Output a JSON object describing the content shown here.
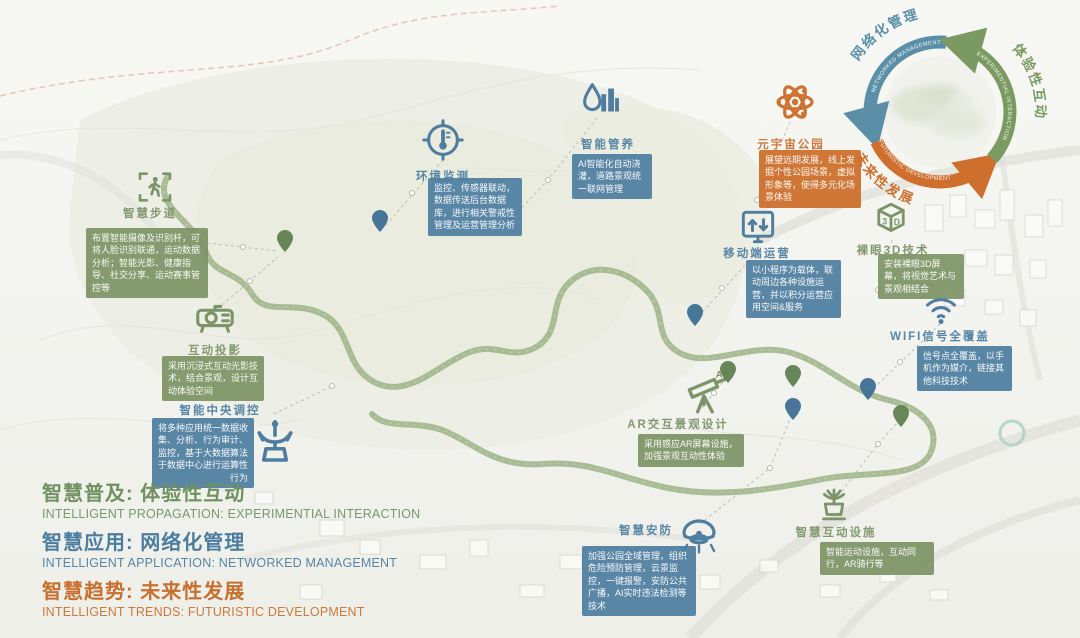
{
  "legend": {
    "items": [
      {
        "zh": "智慧普及: 体验性互动",
        "en": "INTELLIGENT PROPAGATION: EXPERIMENTIAL INTERACTION",
        "theme": "green"
      },
      {
        "zh": "智慧应用: 网络化管理",
        "en": "INTELLIGENT APPLICATION: NETWORKED MANAGEMENT",
        "theme": "blue"
      },
      {
        "zh": "智慧趋势: 未来性发展",
        "en": "INTELLIGENT TRENDS: FUTURISTIC DEVELOPMENT",
        "theme": "orange"
      }
    ]
  },
  "cycle": {
    "segments": [
      {
        "zh": "网络化管理",
        "en": "NETWORKED MANAGEMENT",
        "color": "#5b8fa8"
      },
      {
        "zh": "体验性互动",
        "en": "EXPERIMENTIAL INTERACTION",
        "color": "#7a9a62"
      },
      {
        "zh": "未来性发展",
        "en": "FUTURISTIC DEVELOPMENT",
        "color": "#cf6f2e"
      }
    ]
  },
  "callouts": [
    {
      "id": "walkway",
      "icon": "walking-trail-icon",
      "theme": "green",
      "label": "智慧步道",
      "desc": "布置智能摄像及识别杆，可将人脸识别联通，运动数据分析；智能光影、健康指导、社交分享、运动赛事管控等"
    },
    {
      "id": "projection",
      "icon": "projector-icon",
      "theme": "green",
      "label": "互动投影",
      "desc": "采用沉浸式互动光影技术，结合景观，设计互动体验空间"
    },
    {
      "id": "central",
      "icon": "control-tower-icon",
      "theme": "blue",
      "label": "智能中央调控",
      "desc": "将多种应用统一数据收集、分析、行为审计、监控，基于大数据算法于数据中心进行运算性行为"
    },
    {
      "id": "env",
      "icon": "thermometer-target-icon",
      "theme": "blue",
      "label": "环境监测",
      "desc": "监控、传感器联动，数据传送后台数据库，进行相关警戒性管理及运营管理分析"
    },
    {
      "id": "maintain",
      "icon": "water-greening-icon",
      "theme": "blue",
      "label": "智能管养",
      "desc": "AI智能化自动浇灌，道路景观统一联网管理"
    },
    {
      "id": "metaverse",
      "icon": "atom-icon",
      "theme": "orange",
      "label": "元宇宙公园",
      "desc": "展望远期发展，线上发掘个性公园场景，虚拟形象等，使得多元化场景体验"
    },
    {
      "id": "mobile",
      "icon": "mobile-monitor-icon",
      "theme": "blue",
      "label": "移动端运营",
      "desc": "以小程序为载体，联动周边各种设施运营，并以积分运营应用空间&服务"
    },
    {
      "id": "naked3d",
      "icon": "cube-3d-icon",
      "theme": "green",
      "label": "裸眼3D技术",
      "desc": "安装裸眼3D屏幕，将视觉艺术与景观相结合"
    },
    {
      "id": "wifi",
      "icon": "wifi-icon",
      "theme": "blue",
      "label": "WIFI信号全覆盖",
      "desc": "信号点全覆盖，以手机作为媒介，链接其他科技技术"
    },
    {
      "id": "ar",
      "icon": "ar-telescope-icon",
      "theme": "green",
      "label": "AR交互景观设计",
      "desc": "采用感应AR屏幕设施，加强景观互动性体验"
    },
    {
      "id": "security",
      "icon": "security-camera-icon",
      "theme": "blue",
      "label": "智慧安防",
      "desc": "加强公园全域管理，组织危险预防管理，云景监控，一键报警，安防公共广播，AI实时违法检测等技术"
    },
    {
      "id": "interactive",
      "icon": "fountain-facility-icon",
      "theme": "green",
      "label": "智慧互动设施",
      "desc": "智能运动设施，互动同行，AR骑行等"
    }
  ],
  "pins": [
    {
      "x": 285,
      "y": 252,
      "theme": "green"
    },
    {
      "x": 380,
      "y": 232,
      "theme": "blue"
    },
    {
      "x": 695,
      "y": 326,
      "theme": "blue"
    },
    {
      "x": 728,
      "y": 383,
      "theme": "green"
    },
    {
      "x": 793,
      "y": 387,
      "theme": "green"
    },
    {
      "x": 793,
      "y": 420,
      "theme": "blue"
    },
    {
      "x": 868,
      "y": 400,
      "theme": "blue"
    },
    {
      "x": 901,
      "y": 427,
      "theme": "green"
    }
  ],
  "colors": {
    "green": "#7d9468",
    "blue": "#4e7da0",
    "orange": "#cf7231",
    "pin_green": "#5f7f51",
    "pin_blue": "#3f6f92"
  }
}
